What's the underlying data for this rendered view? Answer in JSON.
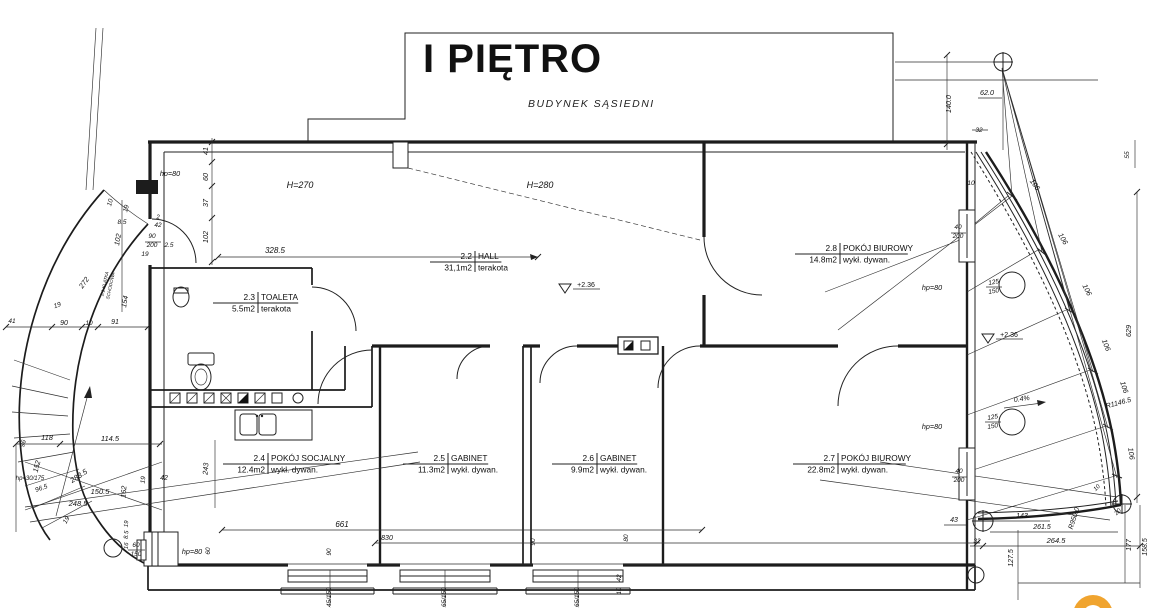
{
  "title": "I PIĘTRO",
  "neighbor_label": "BUDYNEK SĄSIEDNI",
  "colors": {
    "line": "#1c1c1c",
    "watermark_orange": "#f0a42f"
  },
  "rooms": [
    {
      "id": "2.2",
      "name": "HALL",
      "area": "31,1m2",
      "finish": "terakota",
      "cx": 475,
      "cy": 262
    },
    {
      "id": "2.3",
      "name": "TOALETA",
      "area": "5.5m2",
      "finish": "terakota",
      "cx": 258,
      "cy": 303
    },
    {
      "id": "2.4",
      "name": "POKÓJ SOCJALNY",
      "area": "12.4m2",
      "finish": "wykł. dywan.",
      "cx": 268,
      "cy": 464
    },
    {
      "id": "2.5",
      "name": "GABINET",
      "area": "11.3m2",
      "finish": "wykł. dywan.",
      "cx": 448,
      "cy": 464
    },
    {
      "id": "2.6",
      "name": "GABINET",
      "area": "9.9m2",
      "finish": "wykł. dywan.",
      "cx": 597,
      "cy": 464
    },
    {
      "id": "2.7",
      "name": "POKÓJ BIUROWY",
      "area": "22.8m2",
      "finish": "wykł. dywan.",
      "cx": 838,
      "cy": 464
    },
    {
      "id": "2.8",
      "name": "POKÓJ BIUROWY",
      "area": "14.8m2",
      "finish": "wykł. dywan.",
      "cx": 840,
      "cy": 254
    }
  ],
  "annotations": [
    {
      "t": "41",
      "x": 208,
      "y": 151,
      "r": -90
    },
    {
      "t": "hp=80",
      "x": 170,
      "y": 176
    },
    {
      "t": "60",
      "x": 208,
      "y": 177,
      "r": -90
    },
    {
      "t": "37",
      "x": 208,
      "y": 203,
      "r": -90
    },
    {
      "t": "102",
      "x": 208,
      "y": 237,
      "r": -90
    },
    {
      "t": "H=270",
      "x": 300,
      "y": 188,
      "s": 9
    },
    {
      "t": "H=280",
      "x": 540,
      "y": 188,
      "s": 9
    },
    {
      "t": "328.5",
      "x": 275,
      "y": 253,
      "s": 8
    },
    {
      "t": "2",
      "x": 158,
      "y": 219,
      "s": 6
    },
    {
      "t": "42",
      "x": 158,
      "y": 227,
      "s": 6.5
    },
    {
      "t": "90",
      "x": 152,
      "y": 238,
      "s": 6.5
    },
    {
      "t": "200",
      "x": 152,
      "y": 247,
      "s": 6.5
    },
    {
      "t": "2.5",
      "x": 169,
      "y": 247,
      "s": 6.5
    },
    {
      "t": "19",
      "x": 145,
      "y": 256,
      "s": 6.5
    },
    {
      "t": "10",
      "x": 112,
      "y": 203,
      "r": -75,
      "s": 6.5
    },
    {
      "t": "19",
      "x": 128,
      "y": 209,
      "r": -75,
      "s": 6.5
    },
    {
      "t": "8.5",
      "x": 122,
      "y": 224,
      "s": 6.5
    },
    {
      "t": "102",
      "x": 120,
      "y": 240,
      "r": -80
    },
    {
      "t": "154",
      "x": 127,
      "y": 302,
      "r": -80
    },
    {
      "t": "272",
      "x": 86,
      "y": 284,
      "r": -55
    },
    {
      "t": "2.1 KLATKA",
      "x": 106,
      "y": 284,
      "r": -78,
      "s": 4.6
    },
    {
      "t": "SCHODOWA",
      "x": 112,
      "y": 286,
      "r": -78,
      "s": 4.6
    },
    {
      "t": "19",
      "x": 58,
      "y": 307,
      "r": -20,
      "s": 6.5
    },
    {
      "t": "41",
      "x": 12,
      "y": 323,
      "s": 6.5
    },
    {
      "t": "90",
      "x": 64,
      "y": 325,
      "s": 7
    },
    {
      "t": "10",
      "x": 89,
      "y": 325,
      "s": 6.5
    },
    {
      "t": "91",
      "x": 115,
      "y": 324,
      "s": 7
    },
    {
      "t": "96",
      "x": 25,
      "y": 444,
      "r": -75,
      "s": 6.5
    },
    {
      "t": "118",
      "x": 47,
      "y": 440,
      "s": 7.5
    },
    {
      "t": "114.5",
      "x": 110,
      "y": 441,
      "s": 7.5
    },
    {
      "t": "152",
      "x": 39,
      "y": 467,
      "r": -75
    },
    {
      "t": "hp=30/175",
      "x": 30,
      "y": 480,
      "s": 6
    },
    {
      "t": "96.5",
      "x": 42,
      "y": 490,
      "r": -20,
      "s": 6.5
    },
    {
      "t": "283.5",
      "x": 80,
      "y": 478,
      "r": -33,
      "s": 7.5
    },
    {
      "t": "150.5",
      "x": 100,
      "y": 494,
      "s": 7.5
    },
    {
      "t": "248.5",
      "x": 78,
      "y": 506,
      "s": 7.5
    },
    {
      "t": "162",
      "x": 126,
      "y": 492,
      "r": -85
    },
    {
      "t": "19",
      "x": 145,
      "y": 480,
      "r": -85,
      "s": 6.5
    },
    {
      "t": "42",
      "x": 164,
      "y": 480,
      "s": 7
    },
    {
      "t": "19",
      "x": 68,
      "y": 521,
      "r": -60,
      "s": 6.5
    },
    {
      "t": "19",
      "x": 128,
      "y": 524,
      "r": -85,
      "s": 6
    },
    {
      "t": "8.5",
      "x": 128,
      "y": 535,
      "r": -85,
      "s": 6
    },
    {
      "t": "16",
      "x": 128,
      "y": 546,
      "r": -85,
      "s": 6
    },
    {
      "t": "60",
      "x": 136,
      "y": 547,
      "s": 6.5
    },
    {
      "t": "150",
      "x": 136,
      "y": 556,
      "s": 6.5
    },
    {
      "t": "hp=80",
      "x": 192,
      "y": 554
    },
    {
      "t": "60",
      "x": 210,
      "y": 551,
      "r": -90,
      "s": 6.5
    },
    {
      "t": "243",
      "x": 208,
      "y": 469,
      "r": -85
    },
    {
      "t": "661",
      "x": 342,
      "y": 527,
      "s": 8
    },
    {
      "t": "830",
      "x": 387,
      "y": 540,
      "s": 7
    },
    {
      "t": "90",
      "x": 331,
      "y": 552,
      "r": -90,
      "s": 6.5
    },
    {
      "t": "90",
      "x": 535,
      "y": 542,
      "r": -90,
      "s": 6.5
    },
    {
      "t": "80",
      "x": 628,
      "y": 538,
      "r": -90,
      "s": 6.5
    },
    {
      "t": "42",
      "x": 621,
      "y": 578,
      "r": -90,
      "s": 6.5
    },
    {
      "t": "10",
      "x": 621,
      "y": 591,
      "r": -90,
      "s": 6
    },
    {
      "t": "145/150",
      "x": 331,
      "y": 599,
      "r": -90,
      "s": 6.5
    },
    {
      "t": "165/150",
      "x": 446,
      "y": 599,
      "r": -90,
      "s": 6.5
    },
    {
      "t": "165/150",
      "x": 579,
      "y": 599,
      "r": -90,
      "s": 6.5
    },
    {
      "t": "+2.36",
      "x": 586,
      "y": 287,
      "u": 1,
      "s": 7
    },
    {
      "t": "+2.36",
      "x": 1009,
      "y": 337,
      "u": 1,
      "s": 7
    },
    {
      "t": "0.4%",
      "x": 1022,
      "y": 401,
      "r": -8,
      "s": 7
    },
    {
      "t": "R1146.5",
      "x": 1119,
      "y": 405,
      "r": -15,
      "s": 7
    },
    {
      "t": "R950.0",
      "x": 1076,
      "y": 519,
      "r": -72,
      "s": 7
    },
    {
      "t": "106",
      "x": 1033,
      "y": 186,
      "r": 55
    },
    {
      "t": "106",
      "x": 1061,
      "y": 240,
      "r": 60
    },
    {
      "t": "106",
      "x": 1085,
      "y": 291,
      "r": 63
    },
    {
      "t": "106",
      "x": 1104,
      "y": 346,
      "r": 68
    },
    {
      "t": "106",
      "x": 1122,
      "y": 388,
      "r": 72
    },
    {
      "t": "106",
      "x": 1129,
      "y": 454,
      "r": 82
    },
    {
      "t": "629",
      "x": 1131,
      "y": 331,
      "r": -90
    },
    {
      "t": "140.0",
      "x": 951,
      "y": 104,
      "r": -90
    },
    {
      "t": "62.0",
      "x": 987,
      "y": 95
    },
    {
      "t": "32",
      "x": 979,
      "y": 132,
      "s": 6.5
    },
    {
      "t": "55",
      "x": 1129,
      "y": 155,
      "r": -90,
      "s": 6.5
    },
    {
      "t": "10",
      "x": 971,
      "y": 185,
      "s": 6.5
    },
    {
      "t": "40",
      "x": 958,
      "y": 229,
      "s": 6.5
    },
    {
      "t": "200",
      "x": 958,
      "y": 238,
      "s": 6.5
    },
    {
      "t": "hp=80",
      "x": 932,
      "y": 290
    },
    {
      "t": "125",
      "x": 994,
      "y": 284,
      "r": -10,
      "s": 6.5
    },
    {
      "t": "150",
      "x": 994,
      "y": 293,
      "r": -10,
      "s": 6.5
    },
    {
      "t": "hp=80",
      "x": 932,
      "y": 429
    },
    {
      "t": "125",
      "x": 993,
      "y": 419,
      "r": -10,
      "s": 6.5
    },
    {
      "t": "150",
      "x": 993,
      "y": 428,
      "r": -10,
      "s": 6.5
    },
    {
      "t": "40",
      "x": 959,
      "y": 473,
      "s": 6.5
    },
    {
      "t": "200",
      "x": 959,
      "y": 482,
      "s": 6.5
    },
    {
      "t": "43",
      "x": 954,
      "y": 522,
      "s": 7
    },
    {
      "t": "32",
      "x": 977,
      "y": 543,
      "s": 6.5
    },
    {
      "t": "143",
      "x": 1022,
      "y": 518,
      "s": 7
    },
    {
      "t": "261.5",
      "x": 1042,
      "y": 529,
      "s": 7
    },
    {
      "t": "264.5",
      "x": 1056,
      "y": 543,
      "s": 7.5
    },
    {
      "t": "127.5",
      "x": 1013,
      "y": 558,
      "r": -90,
      "s": 7
    },
    {
      "t": "177",
      "x": 1131,
      "y": 545,
      "r": -90,
      "s": 7
    },
    {
      "t": "158.5",
      "x": 1147,
      "y": 547,
      "r": -90,
      "s": 7
    },
    {
      "t": "10",
      "x": 1098,
      "y": 489,
      "r": -45,
      "s": 6
    },
    {
      "t": "20",
      "x": 1119,
      "y": 513,
      "r": -45,
      "s": 6
    }
  ]
}
